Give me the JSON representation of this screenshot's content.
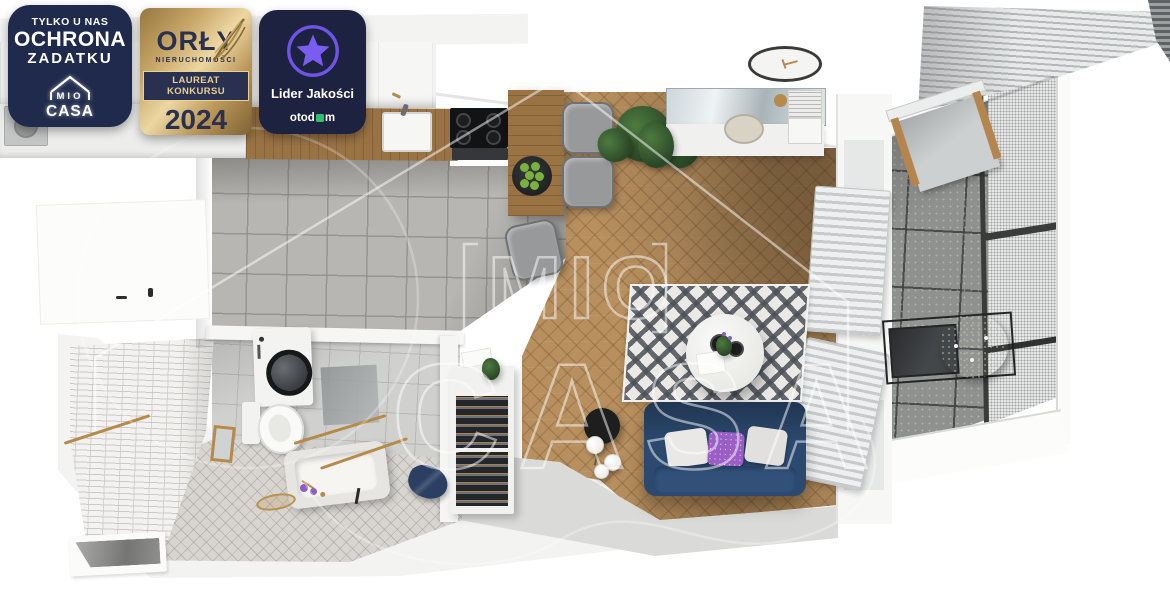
{
  "badges": {
    "exclusive": {
      "line1": "TYLKO U NAS",
      "line2": "OCHRONA",
      "line3": "ZADATKU",
      "logo_top": "MIO",
      "logo_bottom": "CASA"
    },
    "award": {
      "title": "ORŁY",
      "subtitle": "NIERUCHOMOŚCI",
      "banner": "LAUREAT KONKURSU",
      "year": "2024"
    },
    "quality": {
      "label": "Lider Jakości",
      "brand_prefix": "otod",
      "brand_suffix": "m"
    }
  },
  "watermark": {
    "word1": "MIO",
    "word2": "CASA"
  },
  "scene": {
    "kind": "apartment-top-down-3d-render",
    "rooms": [
      "kitchen",
      "living-dining-area",
      "bathroom",
      "hallway",
      "balcony"
    ],
    "furniture": [
      "kitchen-cabinets",
      "sink",
      "cooktop",
      "oven",
      "breakfast-bar",
      "fruit-plate",
      "bar-stools",
      "dining-chair",
      "potted-plant",
      "wall-clock",
      "console-desk",
      "desk-stool",
      "books",
      "radiator",
      "sofa",
      "cushions",
      "area-rug",
      "round-coffee-table",
      "floor-lamp",
      "shoe-cabinet",
      "washing-machine",
      "toilet",
      "bathtub",
      "gold-fixtures",
      "bath-towel",
      "wall-mirror",
      "balcony-awning",
      "mesh-railing",
      "hanging-chair",
      "balcony-table",
      "balcony-plant"
    ],
    "palette": {
      "badge_navy": "#1f2a4d",
      "badge_navy2": "#1d2240",
      "award_navy": "#2a3050",
      "award_gold_light": "#ecd7a2",
      "star_purple": "#7a5cf0",
      "otodom_green": "#2fbe6e",
      "watermark_white": "rgba(255,255,255,0.5)",
      "wood_floor": "#b8905f",
      "counter_wood": "#9a7345",
      "kitchen_tile": "#b8b6b2",
      "bath_tile_wall": "#f3f2f0",
      "bath_floor": "#d0d1cf",
      "corridor_tile": "#d8d5d1",
      "balcony_concrete": "#8f918e",
      "mesh": "#e6e7e6",
      "sofa_navy": "#2c4a70",
      "pillow_purple": "#9a5ec6",
      "rug_light": "#ebe9e6",
      "gold": "#b68a4a",
      "plant_green": "#2a4726",
      "apple_green": "#7ab23f",
      "lamp_black": "#1e1e1e"
    }
  }
}
